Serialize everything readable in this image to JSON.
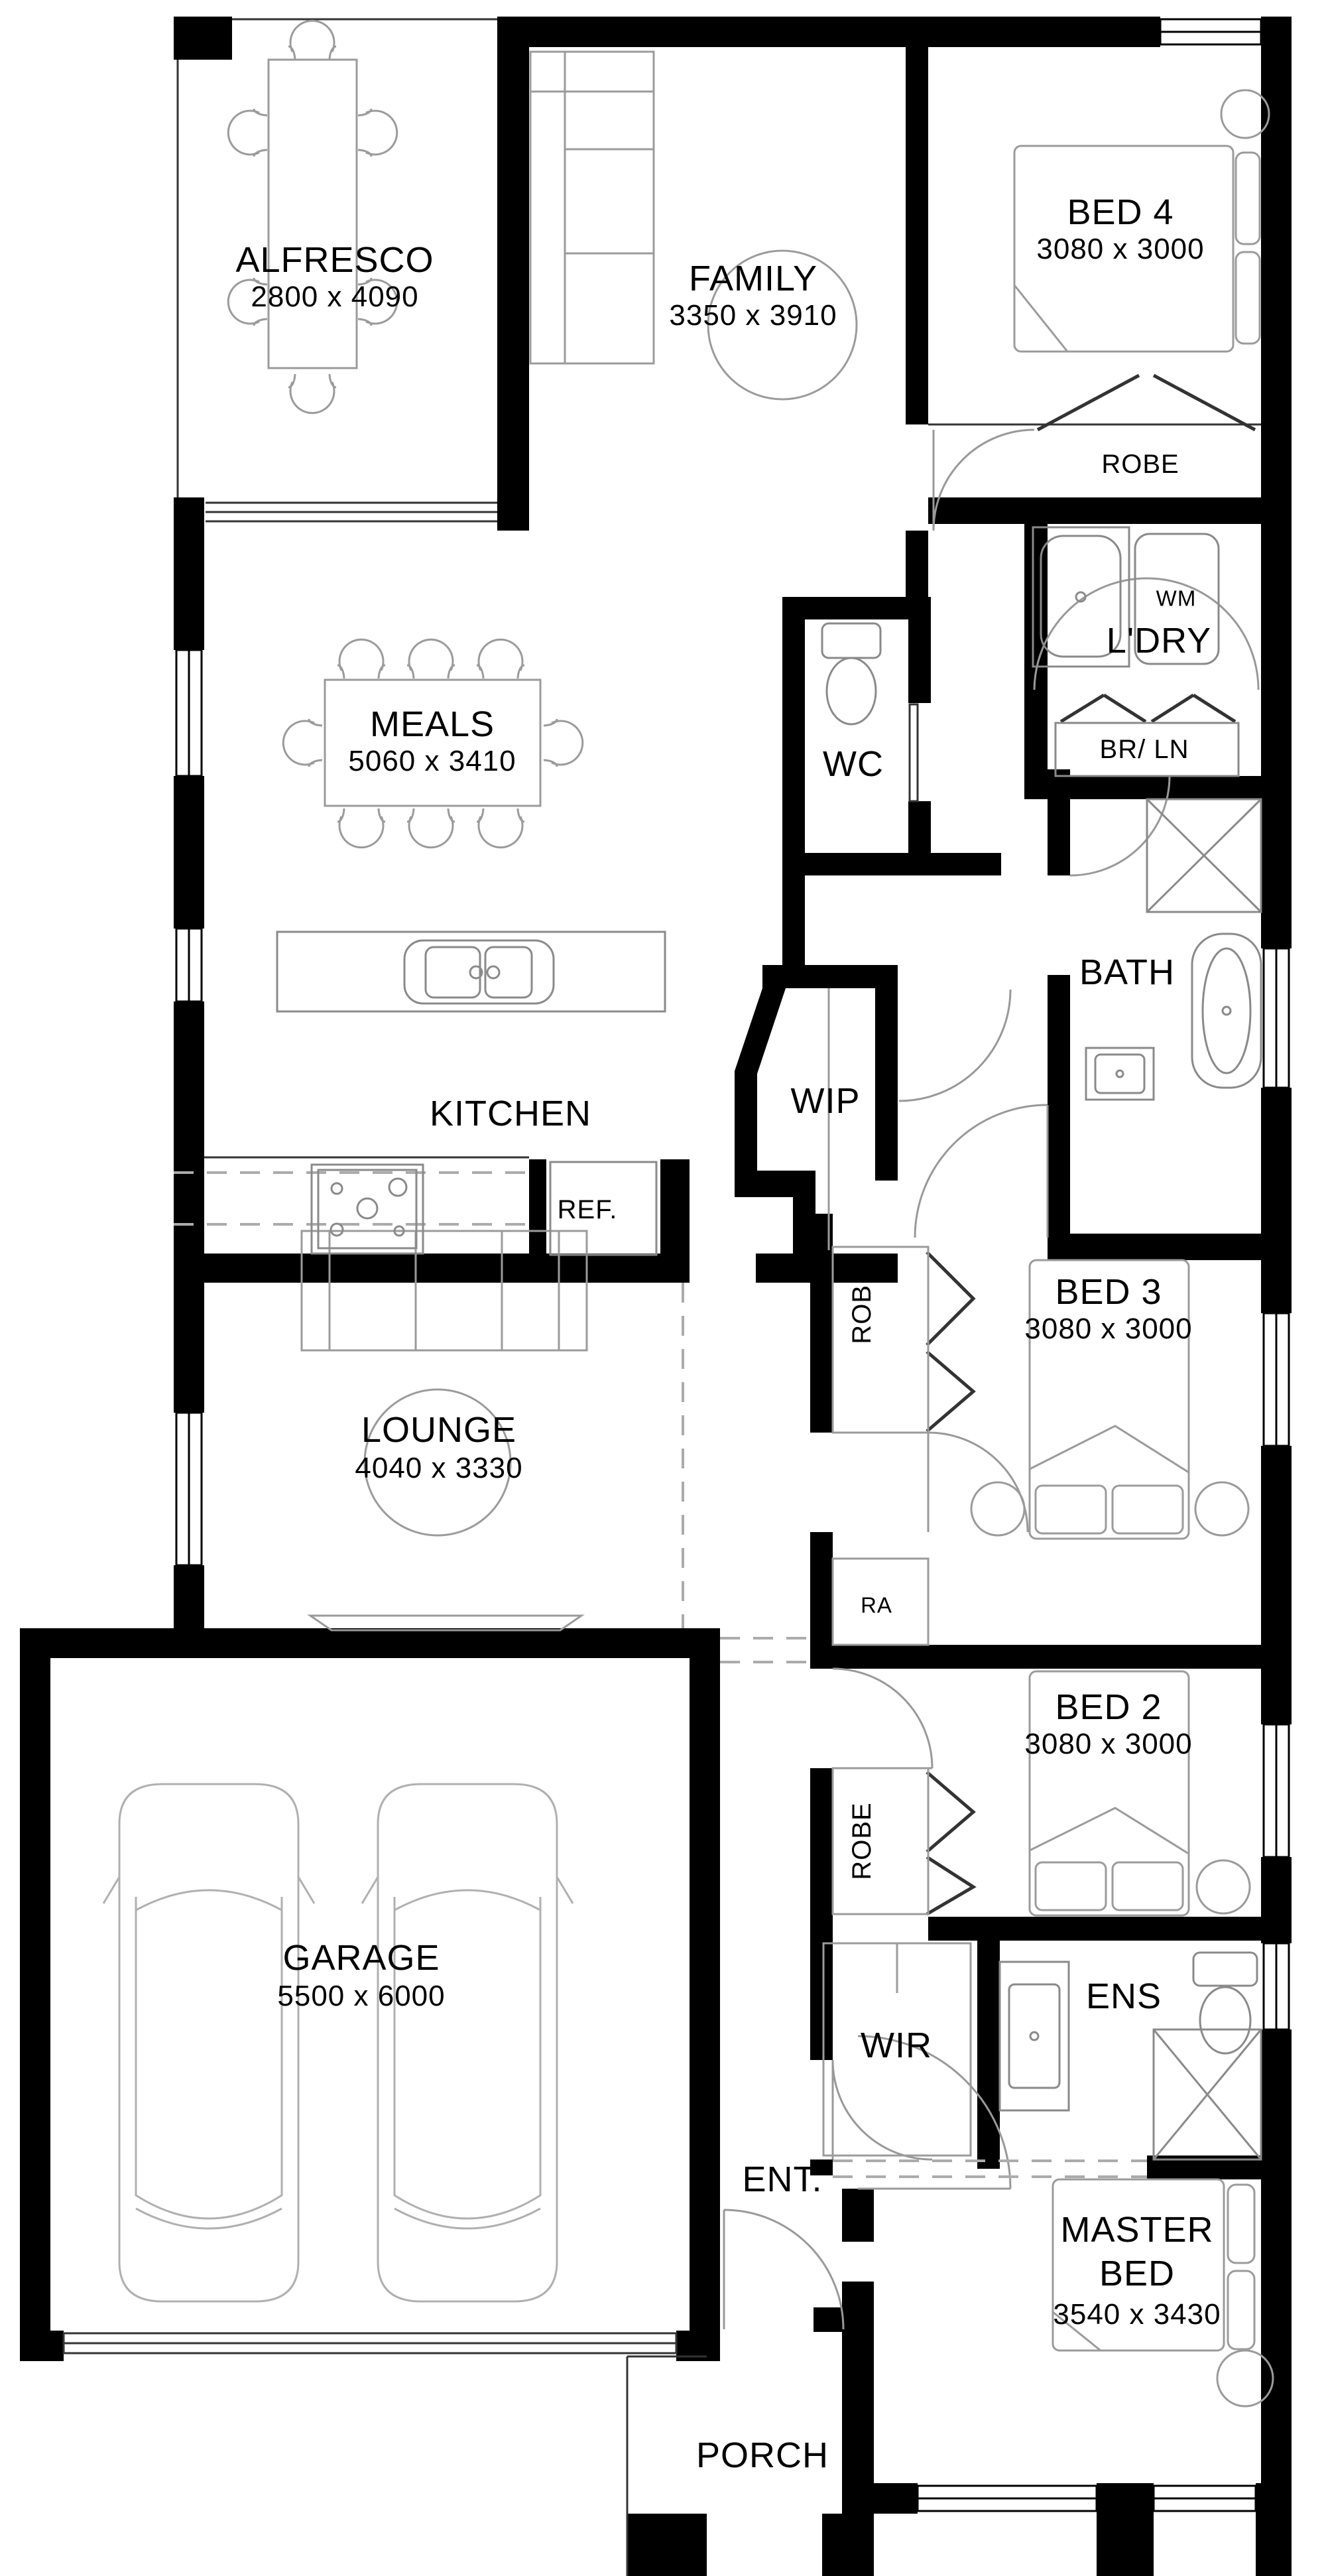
{
  "title": "Single storey home floor plan",
  "colors": {
    "wall": "#000000",
    "furniture_line": "#9b9b9b",
    "fixture_line": "#8a8a8a",
    "dash": "#aaaaaa",
    "background": "#ffffff"
  },
  "rooms": {
    "alfresco": {
      "label": "ALFRESCO",
      "dims": "2800 x 4090"
    },
    "family": {
      "label": "FAMILY",
      "dims": "3350 x 3910"
    },
    "bed4": {
      "label": "BED 4",
      "dims": "3080 x 3000"
    },
    "meals": {
      "label": "MEALS",
      "dims": "5060 x 3410"
    },
    "kitchen": {
      "label": "KITCHEN"
    },
    "wc": {
      "label": "WC"
    },
    "ldry": {
      "label": "L'DRY"
    },
    "bath": {
      "label": "BATH"
    },
    "wip": {
      "label": "WIP"
    },
    "bed3": {
      "label": "BED 3",
      "dims": "3080 x 3000"
    },
    "lounge": {
      "label": "LOUNGE",
      "dims": "4040 x 3330"
    },
    "bed2": {
      "label": "BED 2",
      "dims": "3080 x 3000"
    },
    "garage": {
      "label": "GARAGE",
      "dims": "5500 x 6000"
    },
    "wir": {
      "label": "WIR"
    },
    "ens": {
      "label": "ENS"
    },
    "ent": {
      "label": "ENT."
    },
    "master": {
      "label_line1": "MASTER",
      "label_line2": "BED",
      "dims": "3540 x 3430"
    },
    "porch": {
      "label": "PORCH"
    }
  },
  "annotations": {
    "robe_bed4": "ROBE",
    "robe_bed3": "ROBE",
    "robe_bed2": "ROBE",
    "wm": "WM",
    "br_ln": "BR/ LN",
    "ref": "REF.",
    "ra": "RA"
  }
}
